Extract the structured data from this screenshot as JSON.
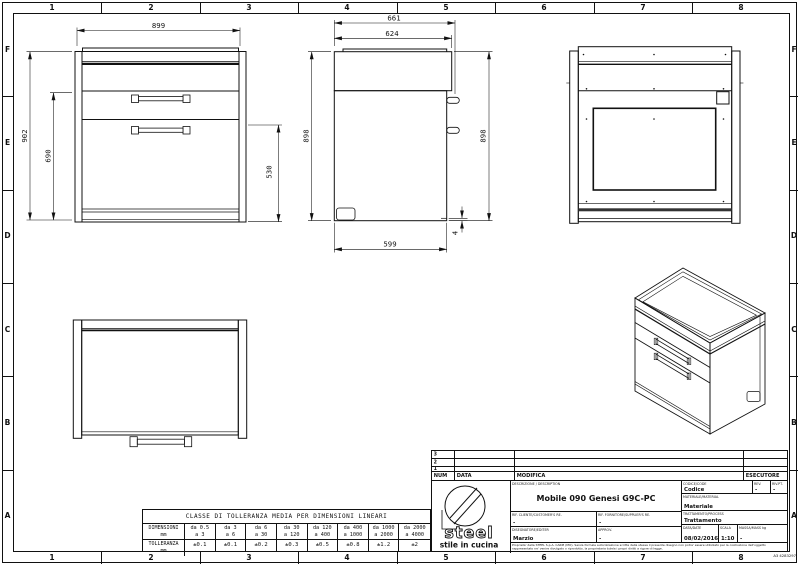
{
  "sheet": {
    "cols": [
      "1",
      "2",
      "3",
      "4",
      "5",
      "6",
      "7",
      "8"
    ],
    "rows": [
      "F",
      "E",
      "D",
      "C",
      "B",
      "A"
    ],
    "doc_ref": "A3 4283297",
    "line_color": "#111111",
    "bg_color": "#ffffff"
  },
  "views": {
    "front": {
      "dims": {
        "w": "899",
        "h": "902",
        "h2": "690",
        "h3": "530"
      }
    },
    "side": {
      "dims": {
        "d": "661",
        "d2": "624",
        "h": "898",
        "d3": "599",
        "gap": "4"
      }
    }
  },
  "tolerance_table": {
    "title": "CLASSE DI TOLLERANZA MEDIA PER DIMENSIONI LINEARI",
    "dim_label": "DIMENSIONI",
    "tol_label": "TOLLERANZA",
    "unit": "mm",
    "dim_top": [
      "da 0.5",
      "da 3",
      "da 6",
      "da 30",
      "da 120",
      "da 400",
      "da 1000",
      "da 2000"
    ],
    "dim_bottom": [
      "a 3",
      "a 6",
      "a 30",
      "a 120",
      "a 400",
      "a 1000",
      "a 2000",
      "a 4000"
    ],
    "tolerances": [
      "±0.1",
      "±0.1",
      "±0.2",
      "±0.3",
      "±0.5",
      "±0.8",
      "±1.2",
      "±2"
    ]
  },
  "title_block": {
    "rev_rows": [
      "3",
      "2",
      "1"
    ],
    "num_label": "NUM",
    "data_col_label": "DATA",
    "modifica_label": "MODIFICA",
    "esecutore_label": "ESECUTORE",
    "logo_brand": "steel",
    "logo_tagline": "stile in cucina",
    "description_label": "DESCRIZIONE / DESCRIPTION",
    "description": "Mobile 090 Genesi G9C-PC",
    "codice_label": "CODICE/CODE",
    "codice": "Codice",
    "rev_label": "REV.",
    "rev": "-",
    "revpt_label": "RIV.PT.",
    "revpt": "-",
    "materiale_label": "MATERIALE/MATERIAL",
    "materiale": "Materiale",
    "rif_cliente_label": "RIF. CLIENTE/CUSTOMER'S RE.",
    "rif_cliente": "-",
    "rif_fornitore_label": "RIF. FORNITORE/SUPPLIER'S RE.",
    "rif_fornitore": "-",
    "trattamento_label": "TRATTAMENTO/PROCESS",
    "trattamento": "Trattamento",
    "disegnatore_label": "DISEGNATORE/EDITER",
    "disegnatore": "Marzio",
    "approv_label": "APPROV.",
    "approv": "-",
    "data_label": "DATA/DATE",
    "data_value": "08/02/2016",
    "scala_label": "SCALA",
    "scala": "1:10",
    "massa_label": "MASSA/MASS kg",
    "massa": "-",
    "disclaimer": "Proprieta' della STEEL S.p.A. CARPI (MO). Senza formale autorizzazione scritta della stessa il presente disegno non potra' essere utilizzato per la costruzione dell'oggetto rappresentato ne' venire divulgato o riprodotto, la proprietaria tutela i propri diritti a rigore di legge."
  }
}
